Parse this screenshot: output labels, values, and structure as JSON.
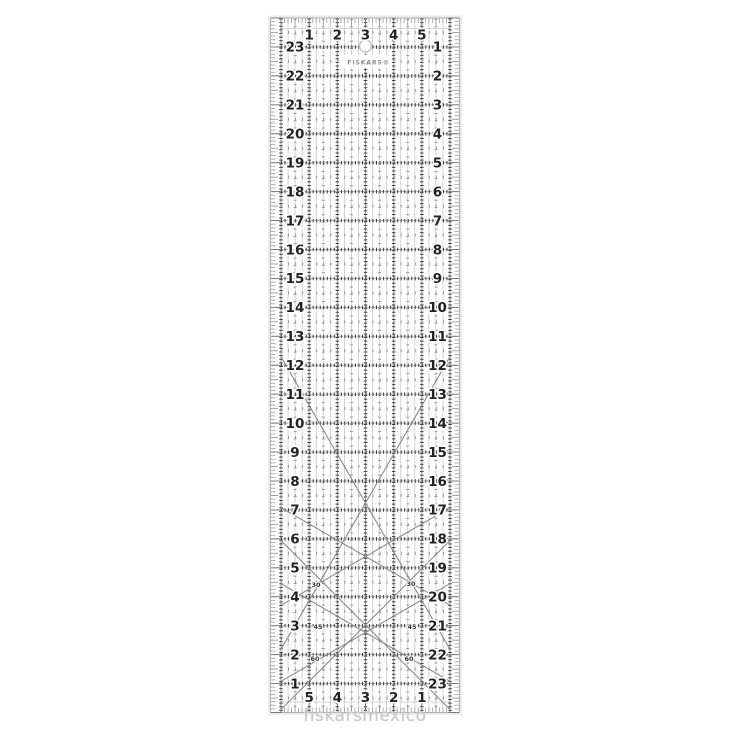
{
  "watermark": "fiskarsmexico",
  "ruler": {
    "brand_logo": "FISKARS®",
    "top_numbers": [
      "1",
      "2",
      "3",
      "4",
      "5"
    ],
    "bottom_numbers": [
      "5",
      "4",
      "3",
      "2",
      "1"
    ],
    "left_numbers": [
      "23",
      "22",
      "21",
      "20",
      "19",
      "18",
      "17",
      "16",
      "15",
      "14",
      "13",
      "12",
      "11",
      "10",
      "9",
      "8",
      "7",
      "6",
      "5",
      "4",
      "3",
      "2",
      "1"
    ],
    "right_numbers": [
      "1",
      "2",
      "3",
      "4",
      "5",
      "6",
      "7",
      "8",
      "9",
      "10",
      "11",
      "12",
      "13",
      "14",
      "15",
      "16",
      "17",
      "18",
      "19",
      "20",
      "21",
      "22",
      "23"
    ],
    "angle_line_labels": [
      "30",
      "30",
      "45",
      "45",
      "60",
      "60"
    ],
    "icons": {
      "hang_hole": "circle"
    },
    "colors": {
      "ink": "#222222",
      "grid_dark": "#3f3f3f",
      "grid_mid": "#9a9a9a",
      "grid_light": "#c9c9c9",
      "edge": "#aeaeae",
      "diagonal": "#8a8a8a",
      "logo": "#8f8f8f",
      "watermark": "#c8c8c8",
      "background": "#ffffff"
    }
  }
}
